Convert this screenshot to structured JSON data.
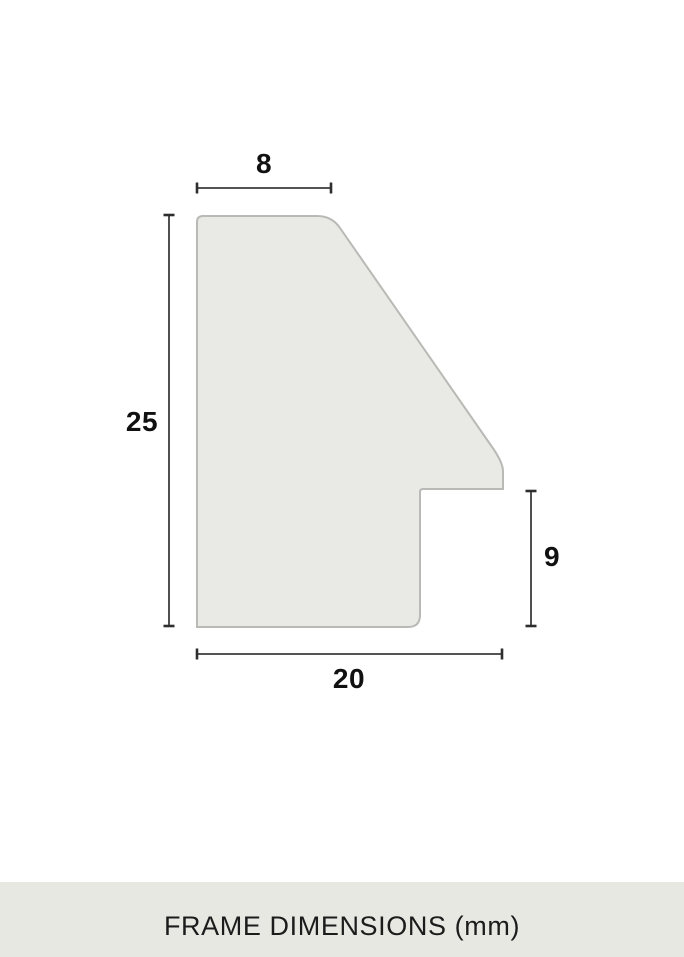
{
  "diagram": {
    "type": "frame-moulding-profile-cross-section",
    "unit": "mm",
    "dimension_labels": {
      "top": "8",
      "left": "25",
      "right": "9",
      "bottom": "20"
    },
    "dimensions_mm": {
      "top_width": 8,
      "left_height": 25,
      "right_rabbet_height": 9,
      "bottom_width": 20
    },
    "colors": {
      "shape_fill": "#e9eae5",
      "shape_outline": "#b9b9b5",
      "dimension_line": "#3c3c3c",
      "label_text": "#111111",
      "footer_background": "#e8e8e3",
      "footer_text": "#1c1c1c",
      "page_background": "#ffffff"
    }
  },
  "footer": {
    "title": "FRAME DIMENSIONS (mm)"
  }
}
